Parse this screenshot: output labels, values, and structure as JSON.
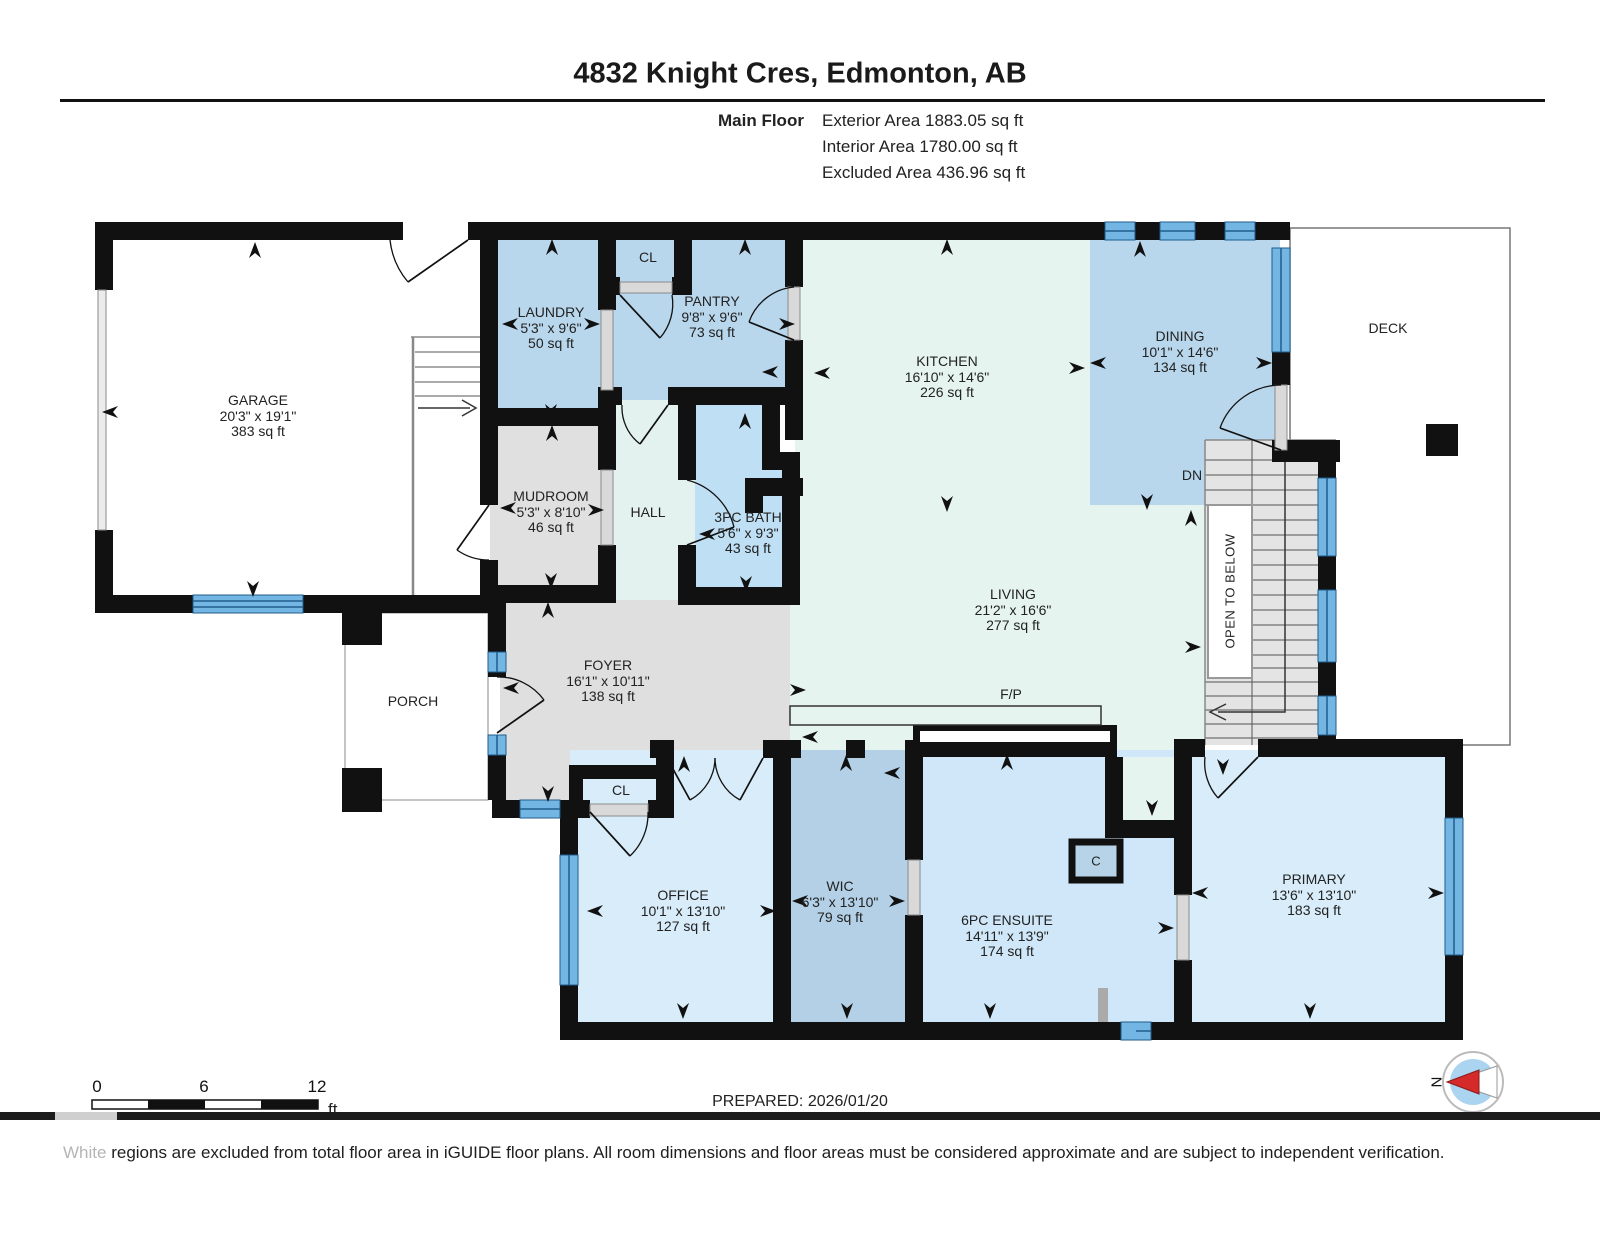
{
  "header": {
    "title": "4832 Knight Cres, Edmonton, AB",
    "floor_label": "Main Floor",
    "stats": [
      "Exterior Area 1883.05 sq ft",
      "Interior Area 1780.00 sq ft",
      "Excluded Area 436.96 sq ft"
    ]
  },
  "rooms": {
    "garage": {
      "name": "GARAGE",
      "dims": "20'3\" x 19'1\"",
      "area": "383 sq ft"
    },
    "laundry": {
      "name": "LAUNDRY",
      "dims": "5'3\" x 9'6\"",
      "area": "50 sq ft"
    },
    "pantry": {
      "name": "PANTRY",
      "dims": "9'8\" x 9'6\"",
      "area": "73 sq ft"
    },
    "kitchen": {
      "name": "KITCHEN",
      "dims": "16'10\" x 14'6\"",
      "area": "226 sq ft"
    },
    "dining": {
      "name": "DINING",
      "dims": "10'1\" x 14'6\"",
      "area": "134 sq ft"
    },
    "mudroom": {
      "name": "MUDROOM",
      "dims": "5'3\" x 8'10\"",
      "area": "46 sq ft"
    },
    "bath": {
      "name": "3PC BATH",
      "dims": "5'6\" x 9'3\"",
      "area": "43 sq ft"
    },
    "living": {
      "name": "LIVING",
      "dims": "21'2\" x 16'6\"",
      "area": "277 sq ft"
    },
    "foyer": {
      "name": "FOYER",
      "dims": "16'1\" x 10'11\"",
      "area": "138 sq ft"
    },
    "office": {
      "name": "OFFICE",
      "dims": "10'1\" x 13'10\"",
      "area": "127 sq ft"
    },
    "wic": {
      "name": "WIC",
      "dims": "6'3\" x 13'10\"",
      "area": "79 sq ft"
    },
    "ensuite": {
      "name": "6PC ENSUITE",
      "dims": "14'11\" x 13'9\"",
      "area": "174 sq ft"
    },
    "primary": {
      "name": "PRIMARY",
      "dims": "13'6\" x 13'10\"",
      "area": "183 sq ft"
    },
    "hall": {
      "name": "HALL"
    },
    "porch": {
      "name": "PORCH"
    },
    "deck": {
      "name": "DECK"
    }
  },
  "labels": {
    "cl_top": "CL",
    "cl_foyer": "CL",
    "c_closet": "C",
    "dn": "DN",
    "open_to_below": "OPEN TO BELOW",
    "fireplace": "F/P"
  },
  "scale_bar": {
    "start": "0",
    "mid": "6",
    "end": "12",
    "unit": "ft"
  },
  "footer": {
    "prepared": "PREPARED: 2026/01/20",
    "note_highlight": "White",
    "note_rest": "regions are excluded from total floor area in iGUIDE floor plans. All room dimensions and floor areas must be considered approximate and are subject to independent verification."
  },
  "compass": {
    "north_label": "N"
  },
  "colors": {
    "wall": "#111111",
    "window_fill": "#74b6e3",
    "window_stripe": "#1f5d8c",
    "room_blue_medium": "#b9d7ec",
    "room_blue_light": "#d8ecf9",
    "room_blue_ensuite": "#cfe7f8",
    "room_blue_bath": "#bfe0f4",
    "room_blue_wic": "#b3d0e6",
    "room_mint": "#e6f4f0",
    "room_gray": "#dfdfdf",
    "stairs_gray": "#e4e4e4",
    "excluded_white": "#ffffff",
    "compass_red": "#d42a2a",
    "compass_blue": "#aad4f0"
  }
}
